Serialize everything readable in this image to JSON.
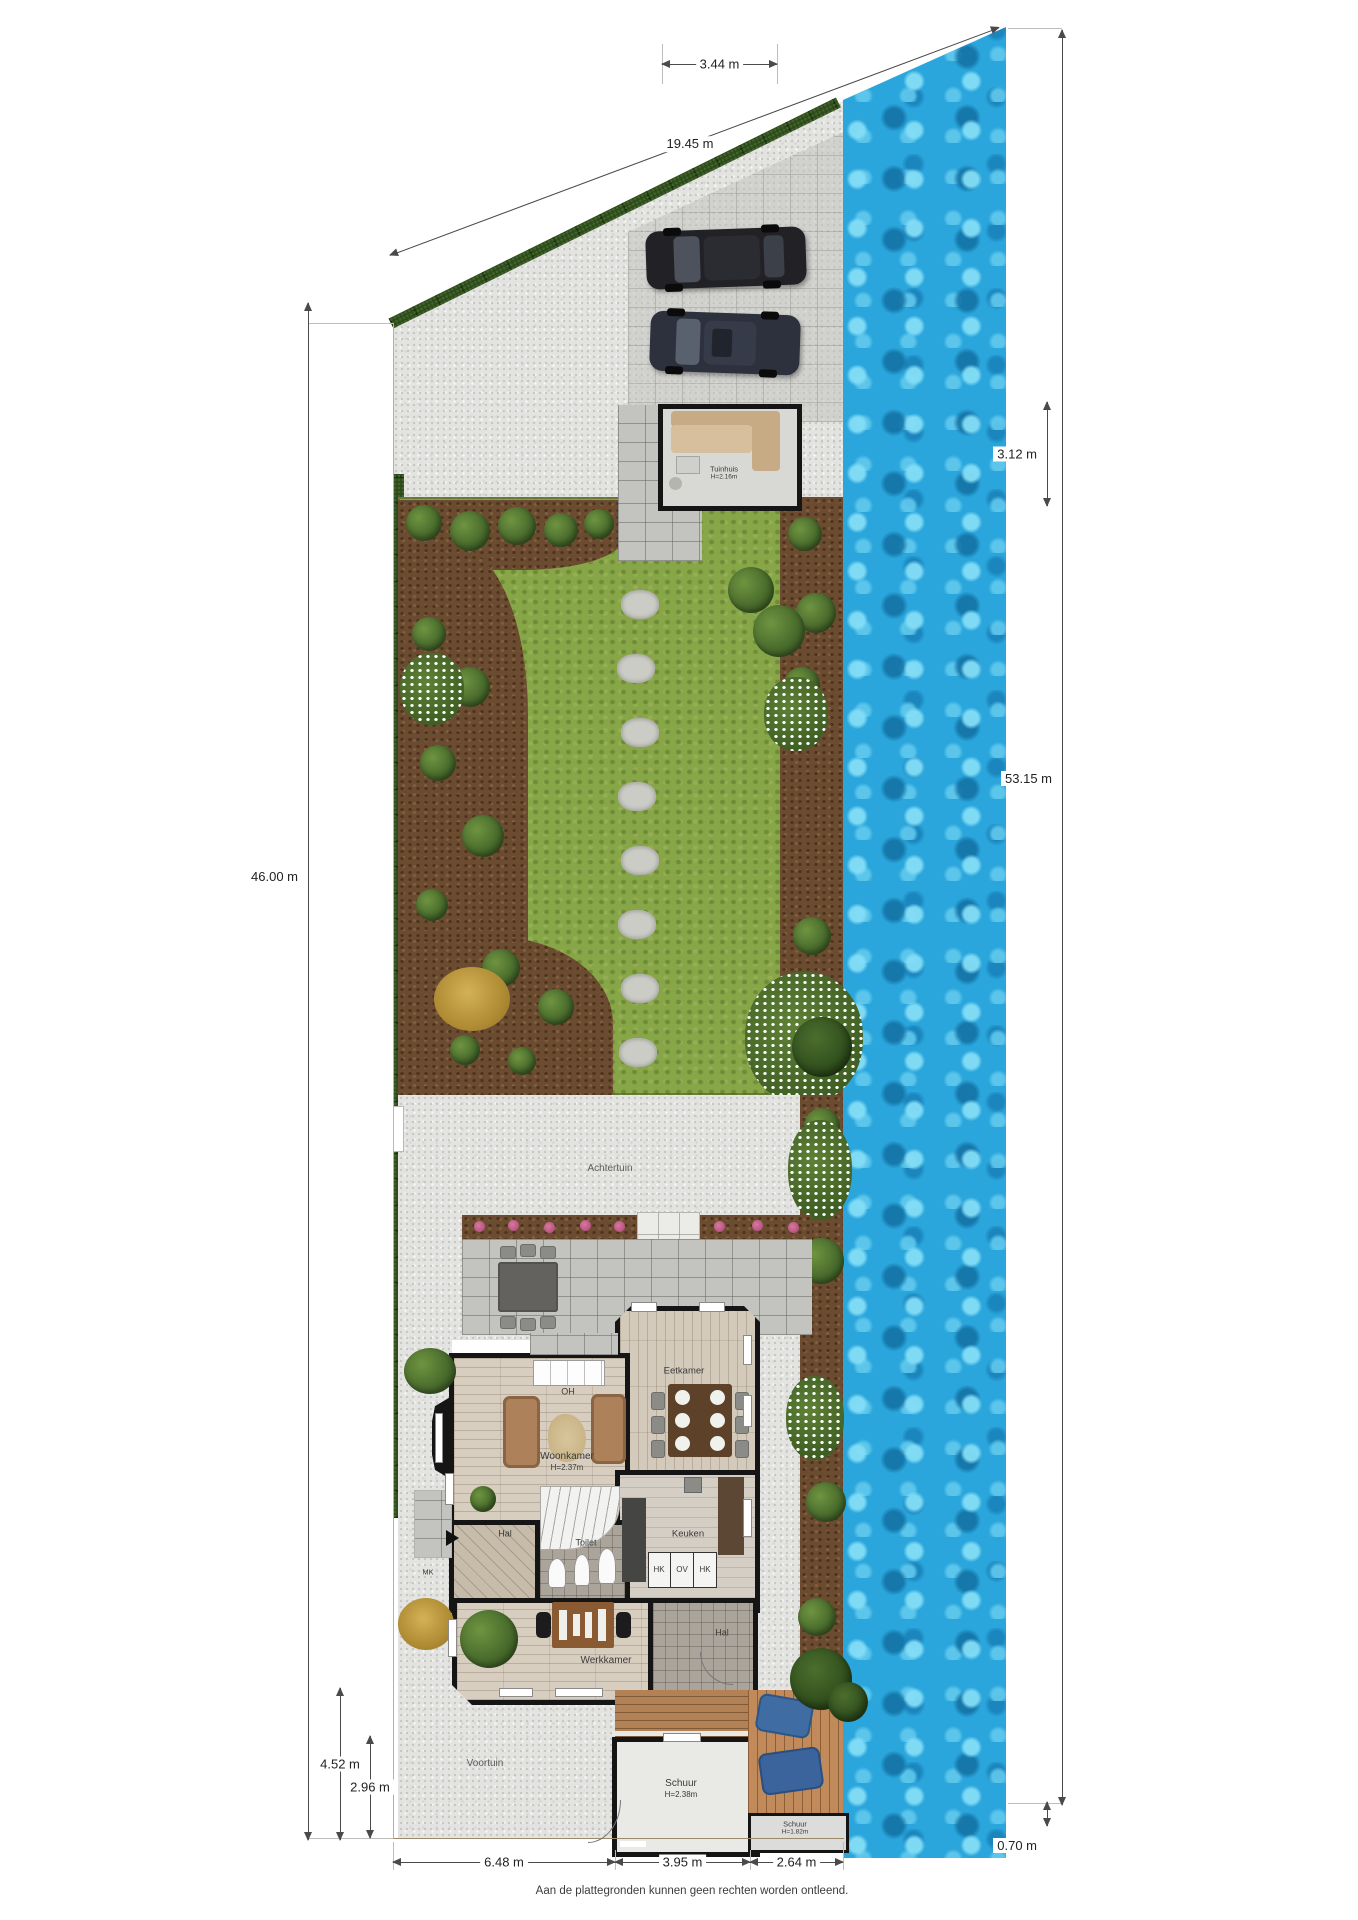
{
  "page": {
    "footer": "Aan de plattegronden kunnen geen rechten worden ontleend."
  },
  "dimensions": {
    "top": "3.44 m",
    "diagonal": "19.45 m",
    "left": "46.00 m",
    "left_outer": "4.52 m",
    "left_inner": "2.96 m",
    "right_upper": "3.12 m",
    "right": "53.15 m",
    "right_lower": "0.70 m",
    "bottom_left": "6.48 m",
    "bottom_mid": "3.95 m",
    "bottom_right": "2.64 m"
  },
  "labels": {
    "achtertuin": "Achtertuin",
    "voortuin": "Voortuin",
    "tuinhuis": "Tuinhuis",
    "tuinhuis_h": "H=2.16m",
    "eetkamer": "Eetkamer",
    "oh": "OH",
    "woonkamer": "Woonkamer",
    "woonkamer_h": "H=2.37m",
    "hal": "Hal",
    "toilet": "Toilet",
    "keuken": "Keuken",
    "hk1": "HK",
    "ov": "OV",
    "hk2": "HK",
    "mk": "MK",
    "werkkamer": "Werkkamer",
    "hal2": "Hal",
    "schuur": "Schuur",
    "schuur_h": "H=2.38m",
    "schuur2": "Schuur",
    "schuur2_h": "H=1.82m"
  },
  "colors": {
    "water": "#2aa6dc",
    "lawn": "#87a647",
    "soil": "#6c4c31",
    "hedge": "#2c4a1b",
    "paving": "#e3e3e1",
    "wall": "#151515",
    "deck": "#b28256",
    "flower_pink": "#c2628a"
  }
}
